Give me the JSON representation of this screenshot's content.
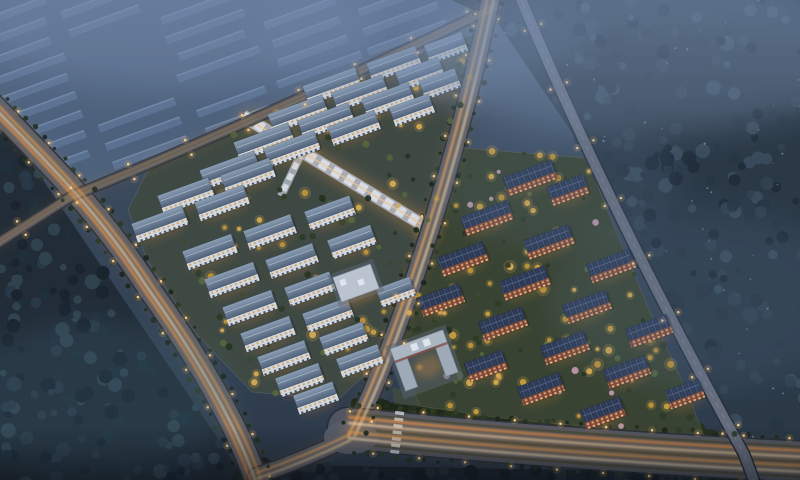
{
  "scene": {
    "description": "Aerial dusk rendering of a residential development: two lit apartment clusters (white slabs left, red-brick slabs right) divided by a diagonal avenue, surrounded by dark forest, a hazy warehouse district top-left, and roads with warm light trails meeting a wide boulevard at the bottom",
    "palette": {
      "sky_top": "#55687f",
      "base_mid": "#3d4d61",
      "base_dark": "#2b3847",
      "road_surface": "#5a5f6b",
      "trail_glow": "#e8963c",
      "trail_bright": "#ffdfae",
      "light_dot": "#ffdf9e",
      "light_halo": "#ffb85c",
      "roof_white_hi": "#93a7bd",
      "roof_white_lo": "#54657c",
      "facade_white": "#dfe5ec",
      "roof_red": "#2c3850",
      "facade_red": "#8e5242",
      "window_warm": "#ffc27a",
      "tree_yellow": "#d6a83e",
      "tree_green": "#2c3b24",
      "mist": "#8aa2c4"
    },
    "regions": {
      "warehouse": {
        "poly": [
          0,
          0,
          468,
          0,
          452,
          26,
          188,
          144,
          80,
          190,
          0,
          112
        ],
        "base": "#465972",
        "slab": "#5a7190",
        "slab_top": "#7b92ae",
        "slab_side": "#3c5470",
        "haze": "#6f88a8"
      },
      "forest_sw": {
        "poly": [
          0,
          108,
          16,
          140,
          250,
          486,
          0,
          486
        ],
        "base": "#202b35",
        "blobs": [
          "#17222c",
          "#283845",
          "#1e2f3a",
          "#31434f"
        ],
        "count": 150
      },
      "forest_ne": {
        "poly": [
          452,
          0,
          806,
          0,
          806,
          442,
          744,
          450,
          700,
          358,
          585,
          152,
          497,
          22
        ],
        "base": "#2b3946",
        "blobs": [
          "#1f2c38",
          "#32424f",
          "#273642",
          "#3a4d5c"
        ],
        "count": 190
      },
      "tree_band_south": {
        "poly": [
          352,
          400,
          716,
          430,
          718,
          447,
          348,
          428
        ],
        "base": "#252e1d",
        "blobs": [
          "#1b2513",
          "#2f3c1e",
          "#26331a"
        ],
        "count": 80
      },
      "south_strip": {
        "poly": [
          238,
          464,
          806,
          474,
          806,
          486,
          230,
          486
        ],
        "base": "#1b232c",
        "blobs": [
          "#141c24",
          "#242f38"
        ],
        "count": 50
      },
      "grass_mid": {
        "poly": [
          392,
          388,
          560,
          406,
          566,
          420,
          394,
          404
        ],
        "base": "#4a5438",
        "blobs": [],
        "count": 0,
        "base_opacity": 0.55
      }
    },
    "roads": [
      {
        "name": "west-arterial",
        "path": "M -10,102 C 45,160 95,205 150,290 C 200,360 240,430 258,486",
        "width": 22,
        "surface": "#5a5f6b",
        "trails": {
          "offsets": [
            [
              -6,
              0
            ],
            [
              -1,
              0
            ],
            [
              5,
              0
            ]
          ],
          "colors": [
            "#ff9e44",
            "#ffdfae",
            "#f0a452"
          ],
          "width": 2,
          "opacity": 0.9
        },
        "lights": {
          "interval": 44,
          "offset": 14
        },
        "trees": {
          "interval": 14,
          "offset": 15
        }
      },
      {
        "name": "north-boundary-road",
        "path": "M -10,248 L 72,196 Q 260,120 497,6",
        "width": 9,
        "surface": "#4e5562",
        "opacity": 0.8,
        "trails": {
          "offsets": [
            [
              0,
              -2
            ],
            [
              0,
              2
            ]
          ],
          "colors": [
            "#e2a65e",
            "#d7b07e"
          ],
          "width": 1.3,
          "opacity": 0.7
        },
        "lights": {
          "interval": 62,
          "offset": 8
        }
      },
      {
        "name": "central-avenue",
        "path": "M 492,-8 C 468,110 428,250 384,362 C 372,394 360,418 351,437",
        "width": 17,
        "surface": "#585f6d",
        "trails": {
          "offsets": [
            [
              -3.2,
              0
            ],
            [
              3.2,
              0
            ]
          ],
          "colors": [
            "#ffb45e",
            "#ffdca4"
          ],
          "width": 1.9,
          "opacity": 0.95
        },
        "lights": {
          "interval": 42,
          "offset": 12
        },
        "trees": {
          "interval": 16,
          "offset": 12
        }
      },
      {
        "name": "southwest-connector",
        "path": "M 351,437 C 320,452 288,465 256,476",
        "width": 15,
        "surface": "#585f6d",
        "trails": {
          "offsets": [
            [
              0,
              -3
            ],
            [
              0,
              3
            ]
          ],
          "colors": [
            "#ffb45e",
            "#ffd9a2"
          ],
          "width": 1.8,
          "opacity": 0.9
        }
      },
      {
        "name": "south-boulevard",
        "path": "M 348,428 C 500,444 650,454 806,462",
        "width": 40,
        "surface": "#525763",
        "medians": {
          "offsets": [
            [
              0,
              -15
            ],
            [
              0,
              0
            ],
            [
              0,
              15
            ]
          ],
          "color": "#3a4233",
          "width": 2.6,
          "opacity": 0.75
        },
        "trails": {
          "offsets": [
            [
              0,
              -11
            ],
            [
              0,
              -5
            ],
            [
              0,
              4
            ],
            [
              0,
              10
            ]
          ],
          "colors": [
            "#ff9a40",
            "#ffddab",
            "#f2a44e",
            "#ffe6c0"
          ],
          "width": 2,
          "opacity": 0.9
        },
        "lights": {
          "interval": 46,
          "offset": 23
        },
        "trees": {
          "interval": 14,
          "offset": 24
        }
      },
      {
        "name": "east-road",
        "path": "M 518,-8 Q 608,208 744,454 L 756,486",
        "width": 10,
        "surface": "#6a7080",
        "overpass": true,
        "trails": {
          "offsets": [
            [
              0,
              0
            ]
          ],
          "colors": [
            "#aeb6c2"
          ],
          "width": 0.9,
          "opacity": 0.55
        },
        "lights": {
          "interval": 64,
          "offset": 9
        }
      }
    ],
    "clusters": {
      "left": {
        "poly": [
          152,
          162,
          448,
          42,
          482,
          32,
          450,
          152,
          426,
          252,
          394,
          348,
          338,
          400,
          252,
          392,
          196,
          334,
          148,
          262,
          128,
          210
        ],
        "ground": "#404a42",
        "fence": "#7e8aa0",
        "building_type": "white",
        "trees": {
          "count": 120,
          "yellow": 0.45,
          "pink": 0.0
        },
        "buildings": [
          [
            332,
            86,
            56
          ],
          [
            394,
            64,
            52
          ],
          [
            446,
            48,
            40
          ],
          [
            298,
            114,
            58
          ],
          [
            360,
            93,
            54
          ],
          [
            420,
            74,
            46
          ],
          [
            264,
            142,
            58
          ],
          [
            326,
            121,
            54
          ],
          [
            388,
            100,
            50
          ],
          [
            440,
            84,
            38
          ],
          [
            230,
            170,
            58
          ],
          [
            292,
            149,
            54
          ],
          [
            354,
            128,
            50
          ],
          [
            412,
            110,
            42
          ],
          [
            186,
            196,
            54
          ],
          [
            248,
            176,
            52
          ],
          [
            160,
            224,
            54
          ],
          [
            222,
            203,
            52
          ],
          [
            210,
            252,
            52
          ],
          [
            270,
            232,
            50
          ],
          [
            330,
            213,
            48
          ],
          [
            232,
            280,
            52
          ],
          [
            292,
            261,
            50
          ],
          [
            352,
            242,
            46
          ],
          [
            250,
            308,
            52
          ],
          [
            310,
            289,
            48
          ],
          [
            268,
            334,
            52
          ],
          [
            328,
            315,
            48
          ],
          [
            396,
            292,
            36
          ],
          [
            284,
            358,
            50
          ],
          [
            344,
            339,
            46
          ],
          [
            300,
            380,
            46
          ],
          [
            360,
            361,
            44
          ],
          [
            316,
            398,
            42
          ]
        ]
      },
      "right": {
        "poly": [
          462,
          148,
          587,
          158,
          612,
          222,
          650,
          312,
          688,
          394,
          704,
          436,
          620,
          430,
          500,
          418,
          420,
          406,
          398,
          352,
          416,
          286,
          434,
          236
        ],
        "ground": "#3a4430",
        "fence": "#8a7a5e",
        "building_type": "red",
        "trees": {
          "count": 150,
          "yellow": 0.5,
          "pink": 0.06
        },
        "buildings": [
          [
            530,
            178,
            52
          ],
          [
            568,
            190,
            38
          ],
          [
            487,
            218,
            50
          ],
          [
            549,
            242,
            48
          ],
          [
            611,
            266,
            46
          ],
          [
            463,
            259,
            48
          ],
          [
            525,
            283,
            48
          ],
          [
            587,
            307,
            46
          ],
          [
            649,
            331,
            44
          ],
          [
            441,
            300,
            44
          ],
          [
            503,
            324,
            46
          ],
          [
            565,
            348,
            46
          ],
          [
            627,
            372,
            44
          ],
          [
            685,
            394,
            36
          ],
          [
            486,
            366,
            40
          ],
          [
            541,
            389,
            44
          ],
          [
            603,
            413,
            42
          ]
        ]
      }
    },
    "landmarks": {
      "school": {
        "cx": 424,
        "cy": 360,
        "angle": -20
      },
      "kindergarten": {
        "cx": 356,
        "cy": 283,
        "angle": -20,
        "w": 40,
        "d": 26
      },
      "commercial_street": {
        "main": "M 243,116 L 428,228",
        "branch": "M 302,152 L 281,196",
        "plaza": [
          428,
          230,
          9
        ]
      },
      "crosswalk": {
        "cx": 397,
        "cy": 434,
        "angle": 7,
        "stripes": 7
      },
      "intersection": {
        "cx": 351,
        "cy": 437,
        "rx": 27,
        "ry": 17
      }
    },
    "effects": {
      "mist": [
        [
          640,
          55,
          230,
          80,
          "#8aa2c4",
          0.32
        ],
        [
          180,
          28,
          200,
          60,
          "#7e96b8",
          0.3
        ],
        [
          420,
          38,
          170,
          52,
          "#7e96b8",
          0.2
        ],
        [
          700,
          300,
          150,
          90,
          "#64809f",
          0.18
        ],
        [
          95,
          400,
          140,
          80,
          "#4f7787",
          0.2
        ],
        [
          560,
          180,
          120,
          70,
          "#6e89aa",
          0.16
        ]
      ],
      "specks": {
        "count": 45,
        "color": "#a9bdd4"
      }
    }
  }
}
